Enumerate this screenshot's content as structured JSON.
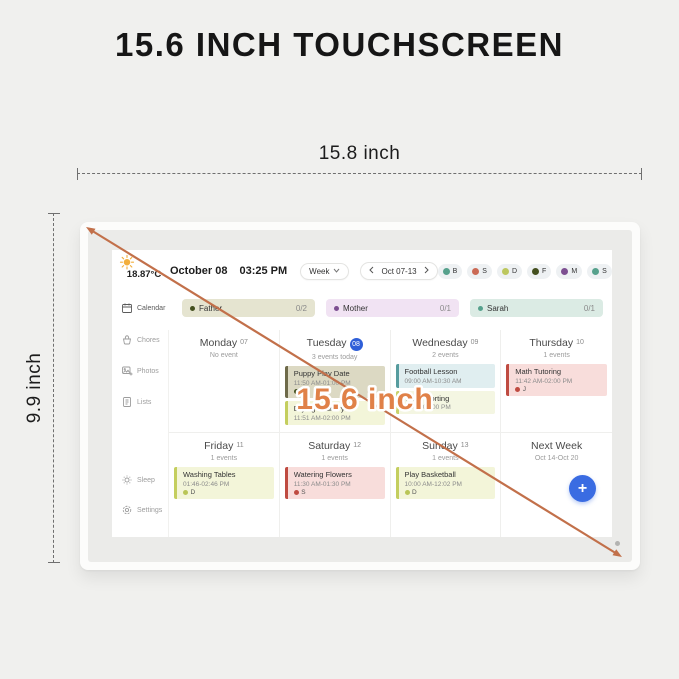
{
  "page": {
    "title": "15.6 INCH TOUCHSCREEN",
    "width_label": "15.8 inch",
    "height_label": "9.9 inch",
    "diagonal_label": "15.6 inch",
    "arrow_color": "#c2704a",
    "diagonal_text_color": "#e08148"
  },
  "screen": {
    "weather": {
      "temp": "18.87°C"
    },
    "header": {
      "date": "October 08",
      "time": "03:25 PM",
      "view": "Week",
      "range": "Oct 07-13",
      "members": [
        {
          "initial": "B",
          "color": "#56a18c"
        },
        {
          "initial": "S",
          "color": "#cb6a55"
        },
        {
          "initial": "D",
          "color": "#bcc75e"
        },
        {
          "initial": "F",
          "color": "#44501f"
        },
        {
          "initial": "M",
          "color": "#7d4f91"
        },
        {
          "initial": "S",
          "color": "#56a18c"
        }
      ]
    },
    "sidebar": [
      {
        "id": "calendar",
        "label": "Calendar",
        "icon": "calendar-icon",
        "active": true
      },
      {
        "id": "chores",
        "label": "Chores",
        "icon": "chores-icon",
        "active": false
      },
      {
        "id": "photos",
        "label": "Photos",
        "icon": "photos-icon",
        "active": false
      },
      {
        "id": "lists",
        "label": "Lists",
        "icon": "lists-icon",
        "active": false
      },
      {
        "id": "sleep",
        "label": "Sleep",
        "icon": "sleep-icon",
        "active": false
      },
      {
        "id": "settings",
        "label": "Settings",
        "icon": "settings-icon",
        "active": false
      }
    ],
    "progress": [
      {
        "name": "Father",
        "count": "0/2",
        "bg": "#e5e4d0",
        "dot": "#44501f"
      },
      {
        "name": "Mother",
        "count": "0/1",
        "bg": "#f1e3f3",
        "dot": "#7d4f91"
      },
      {
        "name": "Sarah",
        "count": "0/1",
        "bg": "#dbebe4",
        "dot": "#56a18c"
      }
    ],
    "week": [
      {
        "name": "Monday",
        "num": "07",
        "sub": "No event",
        "today": false,
        "next_week": false,
        "events": []
      },
      {
        "name": "Tuesday",
        "num": "08",
        "sub": "3 events today",
        "today": true,
        "next_week": false,
        "events": [
          {
            "title": "Puppy Play Date",
            "time": "11:50 AM-01:00 PM",
            "person": "F",
            "person_color": "#44501f",
            "bg": "#dcd9c3",
            "border": "#6e6a4a"
          },
          {
            "title": "Drying Laundry",
            "time": "11:51 AM-02:00 PM",
            "person": "",
            "person_color": "",
            "bg": "#f3f5d9",
            "border": "#c4ce5e"
          }
        ]
      },
      {
        "name": "Wednesday",
        "num": "09",
        "sub": "2 events",
        "today": false,
        "next_week": false,
        "events": [
          {
            "title": "Football Lesson",
            "time": "09:00 AM-10:30 AM",
            "person": "",
            "person_color": "",
            "bg": "#e0eef0",
            "border": "#569c9e"
          },
          {
            "title": "Trash Sorting",
            "time": "01:00-02:00 PM",
            "person": "",
            "person_color": "",
            "bg": "#f4f6e2",
            "border": "#c9d26a"
          }
        ]
      },
      {
        "name": "Thursday",
        "num": "10",
        "sub": "1 events",
        "today": false,
        "next_week": false,
        "events": [
          {
            "title": "Math Tutoring",
            "time": "11:42 AM-02:00 PM",
            "person": "J",
            "person_color": "#bf4b41",
            "bg": "#f8dddb",
            "border": "#bf4b41"
          }
        ]
      },
      {
        "name": "Friday",
        "num": "11",
        "sub": "1 events",
        "today": false,
        "next_week": false,
        "events": [
          {
            "title": "Washing Tables",
            "time": "01:46-02:46 PM",
            "person": "D",
            "person_color": "#b9c556",
            "bg": "#f3f5d9",
            "border": "#c4ce5e"
          }
        ]
      },
      {
        "name": "Saturday",
        "num": "12",
        "sub": "1 events",
        "today": false,
        "next_week": false,
        "events": [
          {
            "title": "Watering Flowers",
            "time": "11:30 AM-01:30 PM",
            "person": "S",
            "person_color": "#bf4b41",
            "bg": "#f8dddb",
            "border": "#bf4b41"
          }
        ]
      },
      {
        "name": "Sunday",
        "num": "13",
        "sub": "1 events",
        "today": false,
        "next_week": false,
        "events": [
          {
            "title": "Play Basketball",
            "time": "10:00 AM-12:02 PM",
            "person": "D",
            "person_color": "#b9c556",
            "bg": "#f3f5d9",
            "border": "#c4ce5e"
          }
        ]
      },
      {
        "name": "Next Week",
        "num": "",
        "sub": "Oct 14-Oct 20",
        "today": false,
        "next_week": true,
        "events": []
      }
    ],
    "add_button_label": "+"
  }
}
